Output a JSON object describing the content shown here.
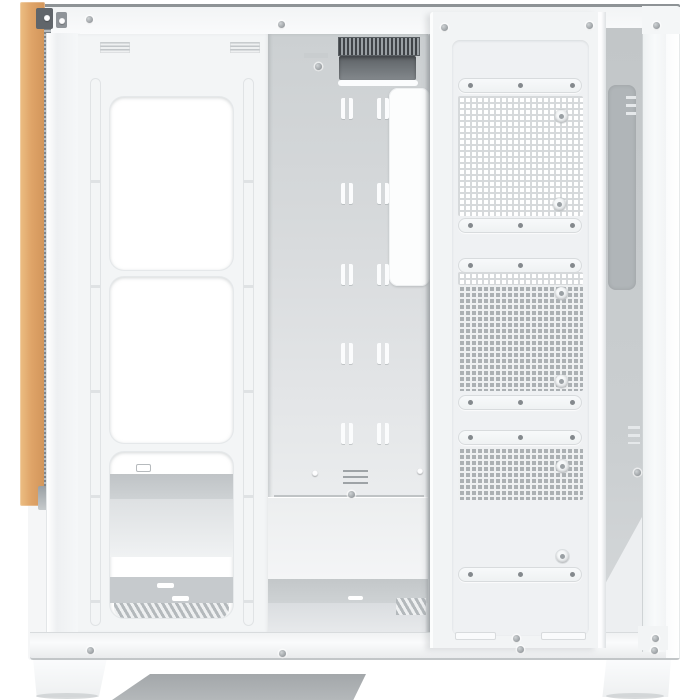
{
  "meta": {
    "type": "product-photo",
    "subject": "White mid-tower PC case, open side view showing cable-management side, wood accent strip on front edge, perforated sliding bracket panel, two case feet",
    "background": "#ffffff"
  },
  "colors": {
    "bg": "#ffffff",
    "caseWhite": "#f5f6f7",
    "panelWhite": "#f2f4f5",
    "bright": "#fdfdfe",
    "edge": "#d9dcde",
    "railTop": "#8e9396",
    "trayTop": "#ccd0d2",
    "trayBottom": "#f1f2f3",
    "interior": "#c2c6c8",
    "interiorDark": "#b0b5b8",
    "recessDark": "#5d6266",
    "finDark": "#3f4347",
    "wood": "#dfa468",
    "woodLight": "#ecbe83",
    "woodDark": "#d2955a",
    "zipper": "#9aa0a5",
    "holeDark": "#abb0b3",
    "gridLineLight": "#d6d9db",
    "gridLineOnDark": "#eef0f1",
    "screwDark": "#84898d",
    "underShadow": "#a8acaf",
    "footShadow": "#c9cdcf",
    "clipDark": "#60656a"
  },
  "counts": {
    "fan_cutouts": 3,
    "mesh_sections": 3,
    "cable_tie_rows": 5,
    "cable_tie_cols": 2,
    "feet": 2,
    "mounting_slot_bars": 6,
    "thumbscrew_holes": 6
  },
  "screws": [
    [
      86,
      16
    ],
    [
      278,
      21
    ],
    [
      653,
      22
    ],
    [
      441,
      24
    ],
    [
      586,
      22
    ],
    [
      513,
      635
    ],
    [
      87,
      647
    ],
    [
      279,
      650
    ],
    [
      517,
      646
    ],
    [
      651,
      647
    ],
    [
      652,
      635
    ],
    [
      634,
      469
    ],
    [
      348,
      491
    ],
    [
      315,
      63
    ]
  ],
  "light_dots": [
    [
      44,
      15
    ],
    [
      59,
      18
    ],
    [
      312,
      470
    ],
    [
      417,
      468
    ]
  ],
  "tie_slots": {
    "cols": [
      73,
      109
    ],
    "rows": [
      64,
      149,
      230,
      309,
      389
    ]
  },
  "slot_bars": {
    "x": 25,
    "w": 124,
    "ys": [
      66,
      206,
      246,
      383,
      418,
      555
    ],
    "dot_offsets": [
      10,
      60,
      112
    ]
  },
  "grids": [
    {
      "x": 25,
      "y": 84,
      "w": 125,
      "h": 120,
      "variant": "light"
    },
    {
      "x": 25,
      "y": 260,
      "w": 125,
      "h": 13,
      "variant": "light"
    },
    {
      "x": 25,
      "y": 273,
      "w": 125,
      "h": 106,
      "variant": "dark"
    },
    {
      "x": 25,
      "y": 435,
      "w": 125,
      "h": 53,
      "variant": "dark"
    }
  ],
  "round_holes": [
    [
      122,
      98
    ],
    [
      120,
      186
    ],
    [
      122,
      275
    ],
    [
      122,
      363
    ],
    [
      123,
      448
    ],
    [
      123,
      538
    ]
  ],
  "bottom_slots": [
    [
      22,
      620,
      41,
      8
    ],
    [
      108,
      620,
      45,
      8
    ]
  ]
}
